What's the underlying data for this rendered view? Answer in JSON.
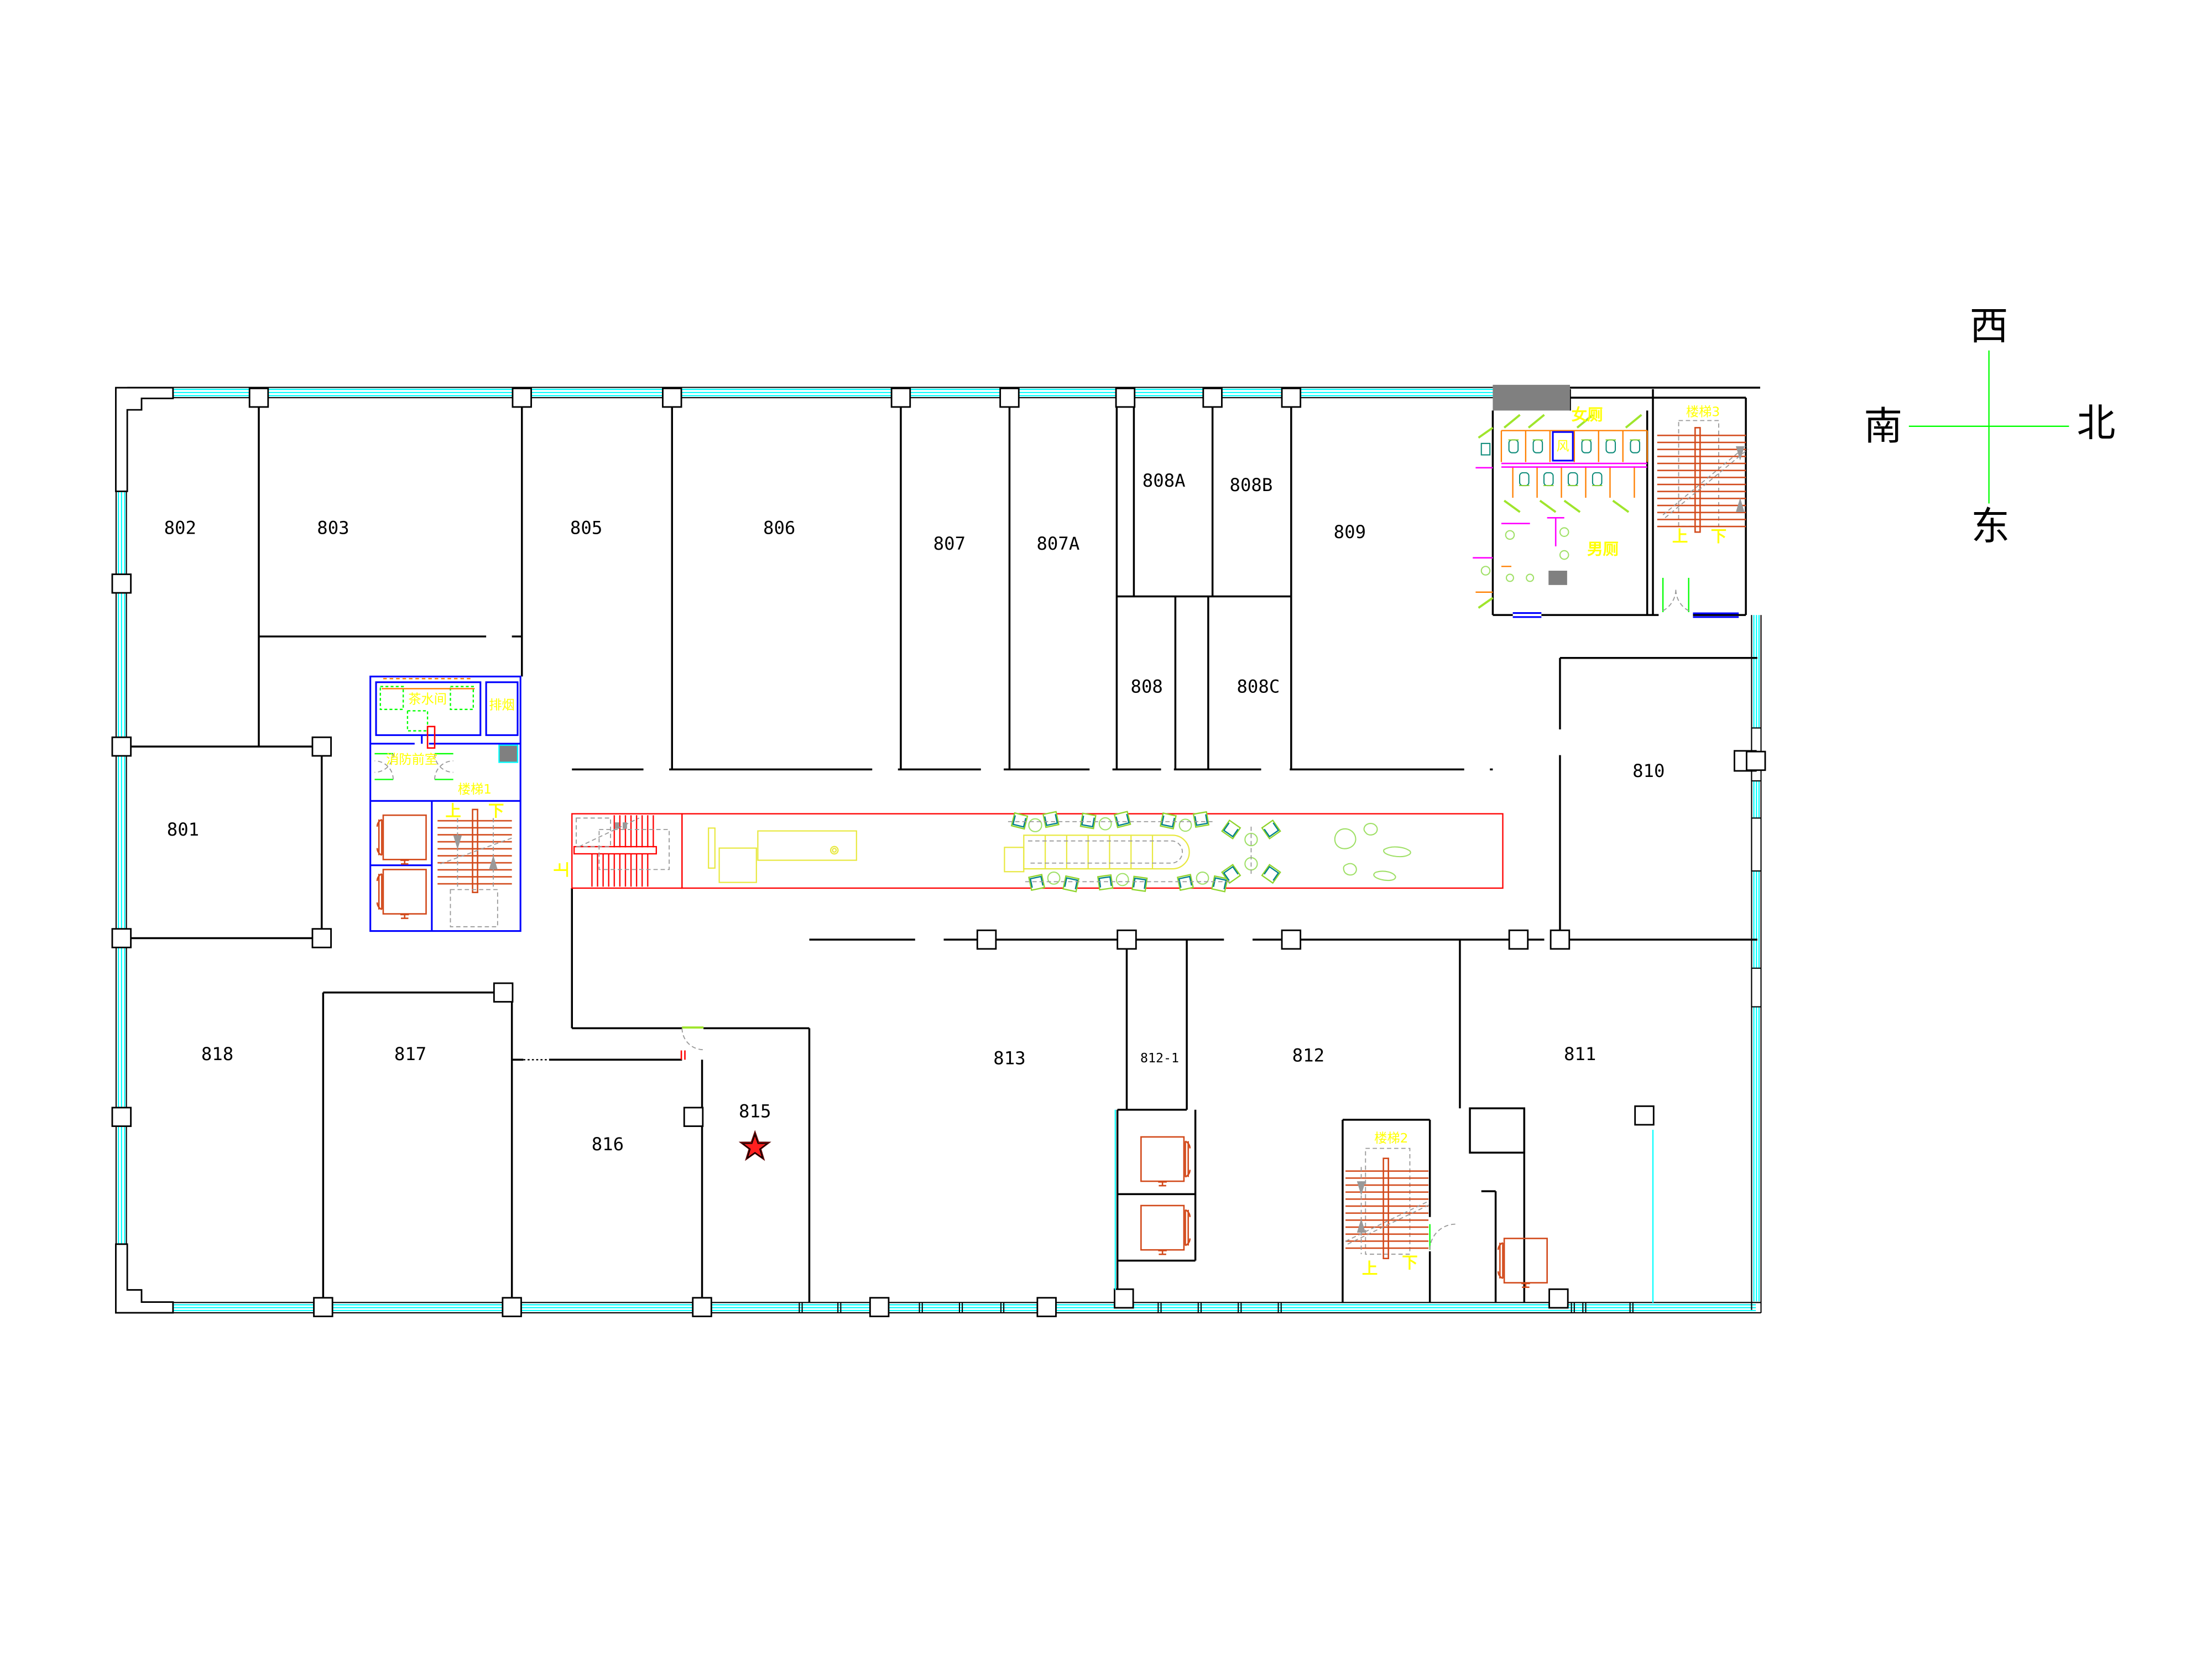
{
  "rooms": [
    {
      "id": "802",
      "label": "802"
    },
    {
      "id": "803",
      "label": "803"
    },
    {
      "id": "805",
      "label": "805"
    },
    {
      "id": "806",
      "label": "806"
    },
    {
      "id": "807",
      "label": "807"
    },
    {
      "id": "807A",
      "label": "807A"
    },
    {
      "id": "808A",
      "label": "808A"
    },
    {
      "id": "808B",
      "label": "808B"
    },
    {
      "id": "809",
      "label": "809"
    },
    {
      "id": "808",
      "label": "808"
    },
    {
      "id": "808C",
      "label": "808C"
    },
    {
      "id": "801",
      "label": "801"
    },
    {
      "id": "810",
      "label": "810"
    },
    {
      "id": "818",
      "label": "818"
    },
    {
      "id": "817",
      "label": "817"
    },
    {
      "id": "816",
      "label": "816"
    },
    {
      "id": "815",
      "label": "815"
    },
    {
      "id": "813",
      "label": "813"
    },
    {
      "id": "812-1",
      "label": "812-1"
    },
    {
      "id": "812",
      "label": "812"
    },
    {
      "id": "811",
      "label": "811"
    }
  ],
  "compass": {
    "west": "西",
    "south": "南",
    "north": "北",
    "east": "东"
  },
  "core": {
    "tea_room": "茶水间",
    "smoke_exhaust": "排烟",
    "fire_lobby": "消防前室",
    "stair1": "楼梯1",
    "up": "上",
    "down": "下"
  },
  "wc": {
    "female": "女厕",
    "male": "男厕",
    "duct": "风"
  },
  "stair2": {
    "name": "楼梯2",
    "up": "上",
    "down": "下"
  },
  "stair3": {
    "name": "楼梯3",
    "up": "上",
    "down": "下"
  },
  "escalator": {
    "up": "上"
  },
  "marker": {
    "type": "star",
    "room": "815"
  },
  "palette": {
    "wall": "#000000",
    "curtain": "#00FFFF",
    "core": "#0000FF",
    "lift": "#D2491A",
    "stall": "#FF7F00",
    "zone": "#FF0000",
    "furn": "#E8E840",
    "ylabel": "#FFFF00",
    "green": "#00FF00",
    "leaf": "#9FE52C",
    "chairg": "#8FD42A",
    "chairt": "#00808C",
    "plant": "#9FE066",
    "mag": "#FF00FF",
    "gray": "#808080",
    "star": "#FF1F1F",
    "dash": "#999999"
  }
}
